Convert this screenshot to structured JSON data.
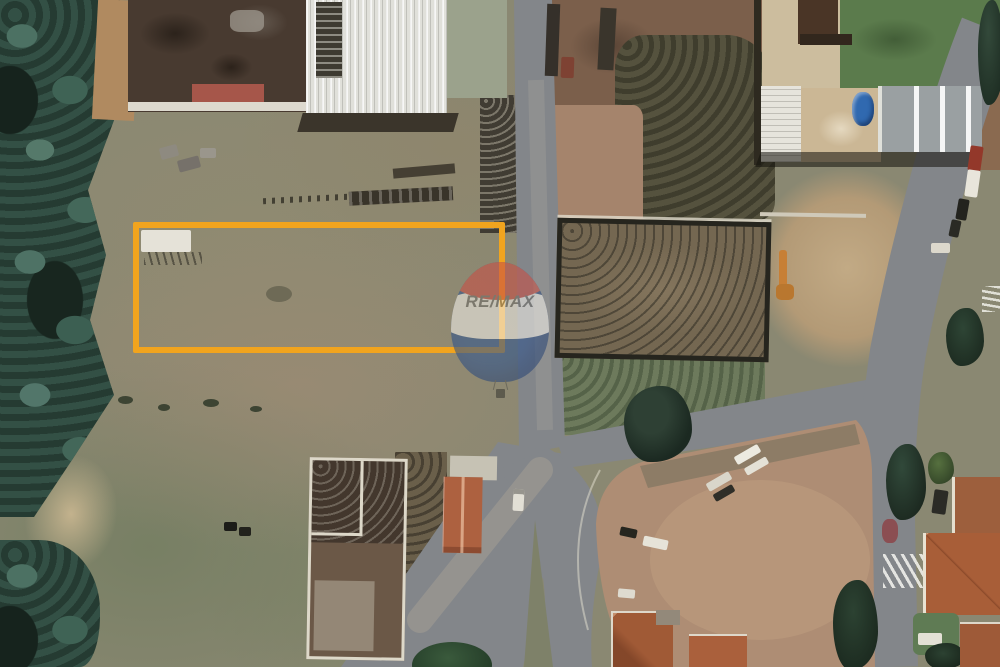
{
  "scene": {
    "kind": "aerial-satellite-photo",
    "features": [
      "forest-strip-west",
      "industrial-yard-northwest",
      "warehouse-white-roof",
      "vertical-road",
      "road-junction-south",
      "main-road-east",
      "northeast-road",
      "highlighted-vacant-lot",
      "fenced-lot-east",
      "light-dirt-yard-east",
      "top-right-building-complex",
      "water-tank-blue",
      "lawn-northeast",
      "timber-piles",
      "walled-compound-south",
      "terracotta-house-south",
      "city-block-southeast",
      "parked-trailers",
      "tree-shadow-center",
      "residential-roofs-southeast",
      "crosswalk-main",
      "crosswalk-right-edge",
      "parked-cars-east-road",
      "remax-balloon-watermark"
    ]
  },
  "highlight_box": {
    "purpose": "advertised-lot-boundary",
    "stroke_color": "#F1A41E",
    "stroke_width_px": 6,
    "x": 133,
    "y": 222,
    "width": 372,
    "height": 131
  },
  "watermark": {
    "brand_text": "RE/MAX",
    "opacity": 0.58,
    "colors": {
      "balloon_top": "#c94f44",
      "balloon_band": "#f2efe9",
      "balloon_bottom": "#31568f",
      "text": "#6f6e6a"
    }
  }
}
